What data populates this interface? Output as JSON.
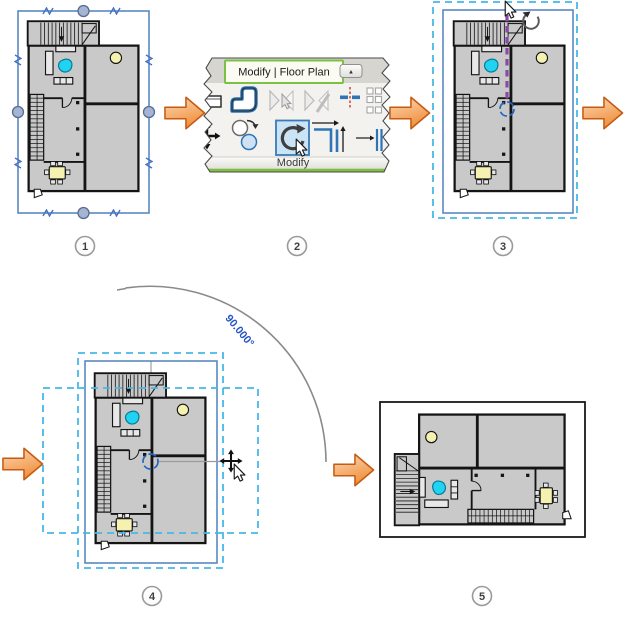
{
  "ribbon": {
    "tab_label": "Modify | Floor Plan",
    "panel_label": "Modify",
    "collapse_glyph": "▲",
    "tools": [
      {
        "name": "wall",
        "state": "enabled"
      },
      {
        "name": "cope",
        "state": "enabled"
      },
      {
        "name": "mirror-pick-axis",
        "state": "disabled"
      },
      {
        "name": "mirror-draw-axis",
        "state": "disabled"
      },
      {
        "name": "split-element",
        "state": "enabled"
      },
      {
        "name": "array",
        "state": "enabled"
      },
      {
        "name": "move",
        "state": "enabled"
      },
      {
        "name": "copy",
        "state": "enabled"
      },
      {
        "name": "rotate",
        "state": "selected"
      },
      {
        "name": "trim-extend-corner",
        "state": "enabled"
      },
      {
        "name": "trim-extend-single",
        "state": "enabled"
      }
    ]
  },
  "annotation": {
    "angle_label": "90.000°"
  },
  "steps": [
    {
      "number": "1"
    },
    {
      "number": "2"
    },
    {
      "number": "3"
    },
    {
      "number": "4"
    },
    {
      "number": "5"
    }
  ],
  "colors": {
    "selection_blue": "#4f81bd",
    "selection_handle_fill": "#a3b4d4",
    "dashed_cyan": "#45b8e8",
    "rotation_axis_purple": "#8a4aa8",
    "rotation_center_blue": "#2465c0",
    "angle_text_blue": "#2353c4",
    "flow_arrow_orange": "#f0913f",
    "flow_arrow_border": "#c55a11",
    "ribbon_tab_green": "#7cc142",
    "tool_highlight_fill": "#cbe4f5",
    "tool_highlight_border": "#3a7ab8",
    "plan_fill": "#c9c9c9",
    "plan_accent_cyan": "#20d3f2",
    "plan_accent_yellow": "#f5f1b0"
  }
}
